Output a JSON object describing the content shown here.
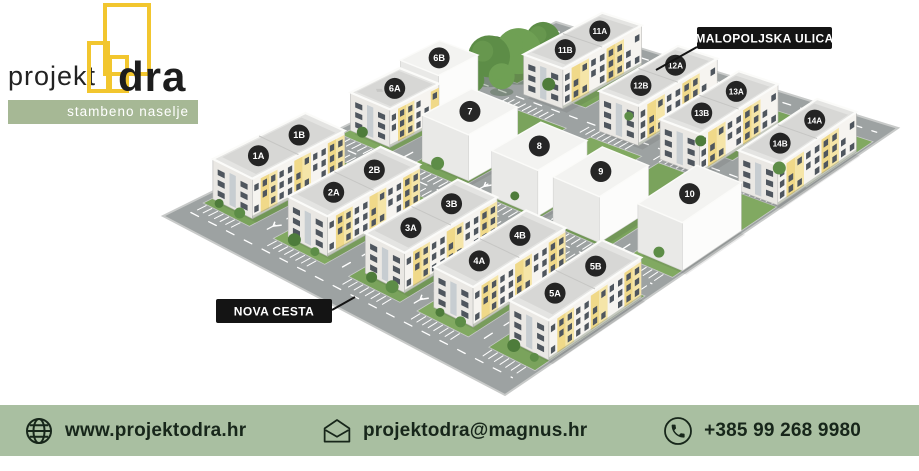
{
  "page": {
    "background": "#ffffff"
  },
  "logo": {
    "brand_prefix": "projekt",
    "brand_suffix": "dra",
    "tagline": "stambeno naselje",
    "mark_color": "#f2c62e",
    "banner_color": "#a6b895"
  },
  "site_plan": {
    "street_labels": [
      {
        "id": "malopoljska-ulica",
        "text": "MALOPOLJSKA ULICA",
        "box": [
          697,
          27,
          135,
          22
        ],
        "leader": [
          [
            697,
            47
          ],
          [
            656,
            70
          ]
        ]
      },
      {
        "id": "nova-cesta",
        "text": "NOVA CESTA",
        "box": [
          216,
          299,
          116,
          24
        ],
        "leader": [
          [
            332,
            310
          ],
          [
            355,
            297
          ]
        ]
      }
    ],
    "buildings": [
      {
        "id": "1",
        "kind": "residential",
        "p": 0.08,
        "q": 0.225,
        "dp": 0.115,
        "dq": 0.235,
        "h": 40,
        "labels": [
          {
            "text": "1A",
            "t": 0.28
          },
          {
            "text": "1B",
            "t": 0.72
          }
        ]
      },
      {
        "id": "2",
        "kind": "residential",
        "p": 0.3,
        "q": 0.225,
        "dp": 0.115,
        "dq": 0.235,
        "h": 40,
        "labels": [
          {
            "text": "2A",
            "t": 0.28
          },
          {
            "text": "2B",
            "t": 0.72
          }
        ]
      },
      {
        "id": "3",
        "kind": "residential",
        "p": 0.52,
        "q": 0.23,
        "dp": 0.115,
        "dq": 0.235,
        "h": 40,
        "labels": [
          {
            "text": "3A",
            "t": 0.28
          },
          {
            "text": "3B",
            "t": 0.72
          }
        ]
      },
      {
        "id": "4",
        "kind": "residential",
        "p": 0.72,
        "q": 0.23,
        "dp": 0.115,
        "dq": 0.235,
        "h": 40,
        "labels": [
          {
            "text": "4A",
            "t": 0.28
          },
          {
            "text": "4B",
            "t": 0.72
          }
        ]
      },
      {
        "id": "5",
        "kind": "residential",
        "p": 0.93,
        "q": 0.24,
        "dp": 0.115,
        "dq": 0.235,
        "h": 40,
        "labels": [
          {
            "text": "5A",
            "t": 0.28
          },
          {
            "text": "5B",
            "t": 0.72
          }
        ]
      },
      {
        "id": "6A",
        "kind": "residential",
        "p": 0.08,
        "q": 0.52,
        "dp": 0.115,
        "dq": 0.125,
        "h": 38,
        "labels": [
          {
            "text": "6A",
            "t": 0.5
          }
        ]
      },
      {
        "id": "6B",
        "kind": "massing",
        "p": 0.08,
        "q": 0.633,
        "dp": 0.112,
        "dq": 0.1,
        "h": 46,
        "labels": [
          {
            "text": "6B",
            "t": 0.5
          }
        ]
      },
      {
        "id": "7",
        "kind": "massing",
        "p": 0.3,
        "q": 0.52,
        "dp": 0.135,
        "dq": 0.125,
        "h": 46,
        "labels": [
          {
            "text": "7",
            "t": 0.5
          }
        ]
      },
      {
        "id": "8",
        "kind": "massing",
        "p": 0.52,
        "q": 0.505,
        "dp": 0.135,
        "dq": 0.125,
        "h": 46,
        "labels": [
          {
            "text": "8",
            "t": 0.5
          }
        ]
      },
      {
        "id": "9",
        "kind": "massing",
        "p": 0.7,
        "q": 0.505,
        "dp": 0.135,
        "dq": 0.125,
        "h": 46,
        "labels": [
          {
            "text": "9",
            "t": 0.5
          }
        ]
      },
      {
        "id": "10",
        "kind": "massing",
        "p": 0.925,
        "q": 0.535,
        "dp": 0.13,
        "dq": 0.15,
        "h": 48,
        "labels": [
          {
            "text": "10",
            "t": 0.5
          }
        ]
      },
      {
        "id": "11",
        "kind": "residential",
        "p": 0.25,
        "q": 0.85,
        "dp": 0.115,
        "dq": 0.2,
        "h": 40,
        "labels": [
          {
            "text": "11B",
            "t": 0.28
          },
          {
            "text": "11A",
            "t": 0.72
          }
        ]
      },
      {
        "id": "12",
        "kind": "residential",
        "p": 0.5,
        "q": 0.825,
        "dp": 0.115,
        "dq": 0.2,
        "h": 40,
        "labels": [
          {
            "text": "12B",
            "t": 0.28
          },
          {
            "text": "12A",
            "t": 0.72
          }
        ]
      },
      {
        "id": "13",
        "kind": "residential",
        "p": 0.695,
        "q": 0.81,
        "dp": 0.115,
        "dq": 0.2,
        "h": 40,
        "labels": [
          {
            "text": "13B",
            "t": 0.28
          },
          {
            "text": "13A",
            "t": 0.72
          }
        ]
      },
      {
        "id": "14",
        "kind": "residential",
        "p": 0.93,
        "q": 0.805,
        "dp": 0.115,
        "dq": 0.2,
        "h": 40,
        "labels": [
          {
            "text": "14B",
            "t": 0.28
          },
          {
            "text": "14A",
            "t": 0.72
          }
        ]
      }
    ],
    "colors": {
      "grass": "#7aa35c",
      "grass_alt": "#81a961",
      "road": "#9da2a2",
      "curb": "#c8cac9",
      "roof": "#d7d7d5",
      "facade": "#f6f4f0",
      "facade_side": "#eae8e4",
      "accent": "#f0d989",
      "accent_light": "#f5e5a8",
      "window": "#4f565e",
      "block_roof": "#f3f3f1",
      "block_face": "#fcfcfb",
      "block_side": "#e9e9e7",
      "marker_bg": "#1a1a1a",
      "marker_text": "#ffffff",
      "tree_dark": "#4e7c3b",
      "tree_mid": "#5d8d47",
      "tree_light": "#6fa054",
      "stripe": "#ffffff"
    }
  },
  "footer": {
    "background": "#a9bfa1",
    "text_color": "#17261a",
    "items": [
      {
        "id": "website",
        "icon": "globe-icon",
        "text": "www.projektodra.hr"
      },
      {
        "id": "email",
        "icon": "envelope-icon",
        "text": "projektodra@magnus.hr"
      },
      {
        "id": "phone",
        "icon": "phone-icon",
        "text": "+385 99 268 9980"
      }
    ]
  }
}
